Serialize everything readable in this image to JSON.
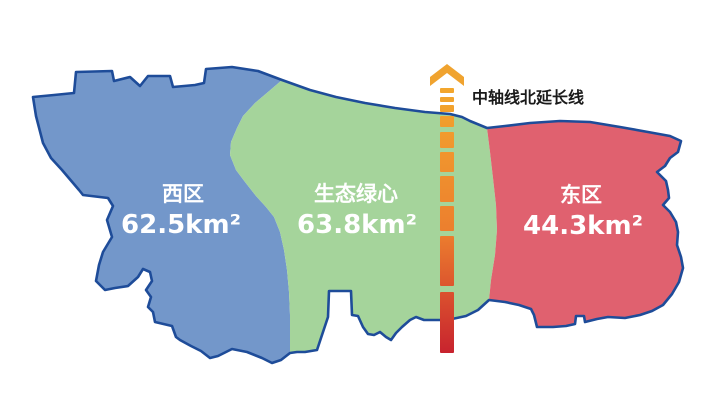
{
  "figure": {
    "background": "#FFFFFF",
    "outline_color": "#1E4C99"
  },
  "regions": [
    {
      "key": "west",
      "name": "西区",
      "area_label": "62.5km²",
      "area_km2": 62.5,
      "fill": "#7397CA"
    },
    {
      "key": "green-heart",
      "name": "生态绿心",
      "area_label": "63.8km²",
      "area_km2": 63.8,
      "fill": "#A5D49B"
    },
    {
      "key": "east",
      "name": "东区",
      "area_label": "44.3km²",
      "area_km2": 44.3,
      "fill": "#E0616F"
    }
  ],
  "axis": {
    "label": "中轴线北延长线",
    "label_color": "#1A1A1A",
    "arrow_color": "#F0A32F",
    "gradient_top": "#F3A72D",
    "gradient_mid": "#EC7E2E",
    "gradient_bottom": "#C8232E"
  }
}
